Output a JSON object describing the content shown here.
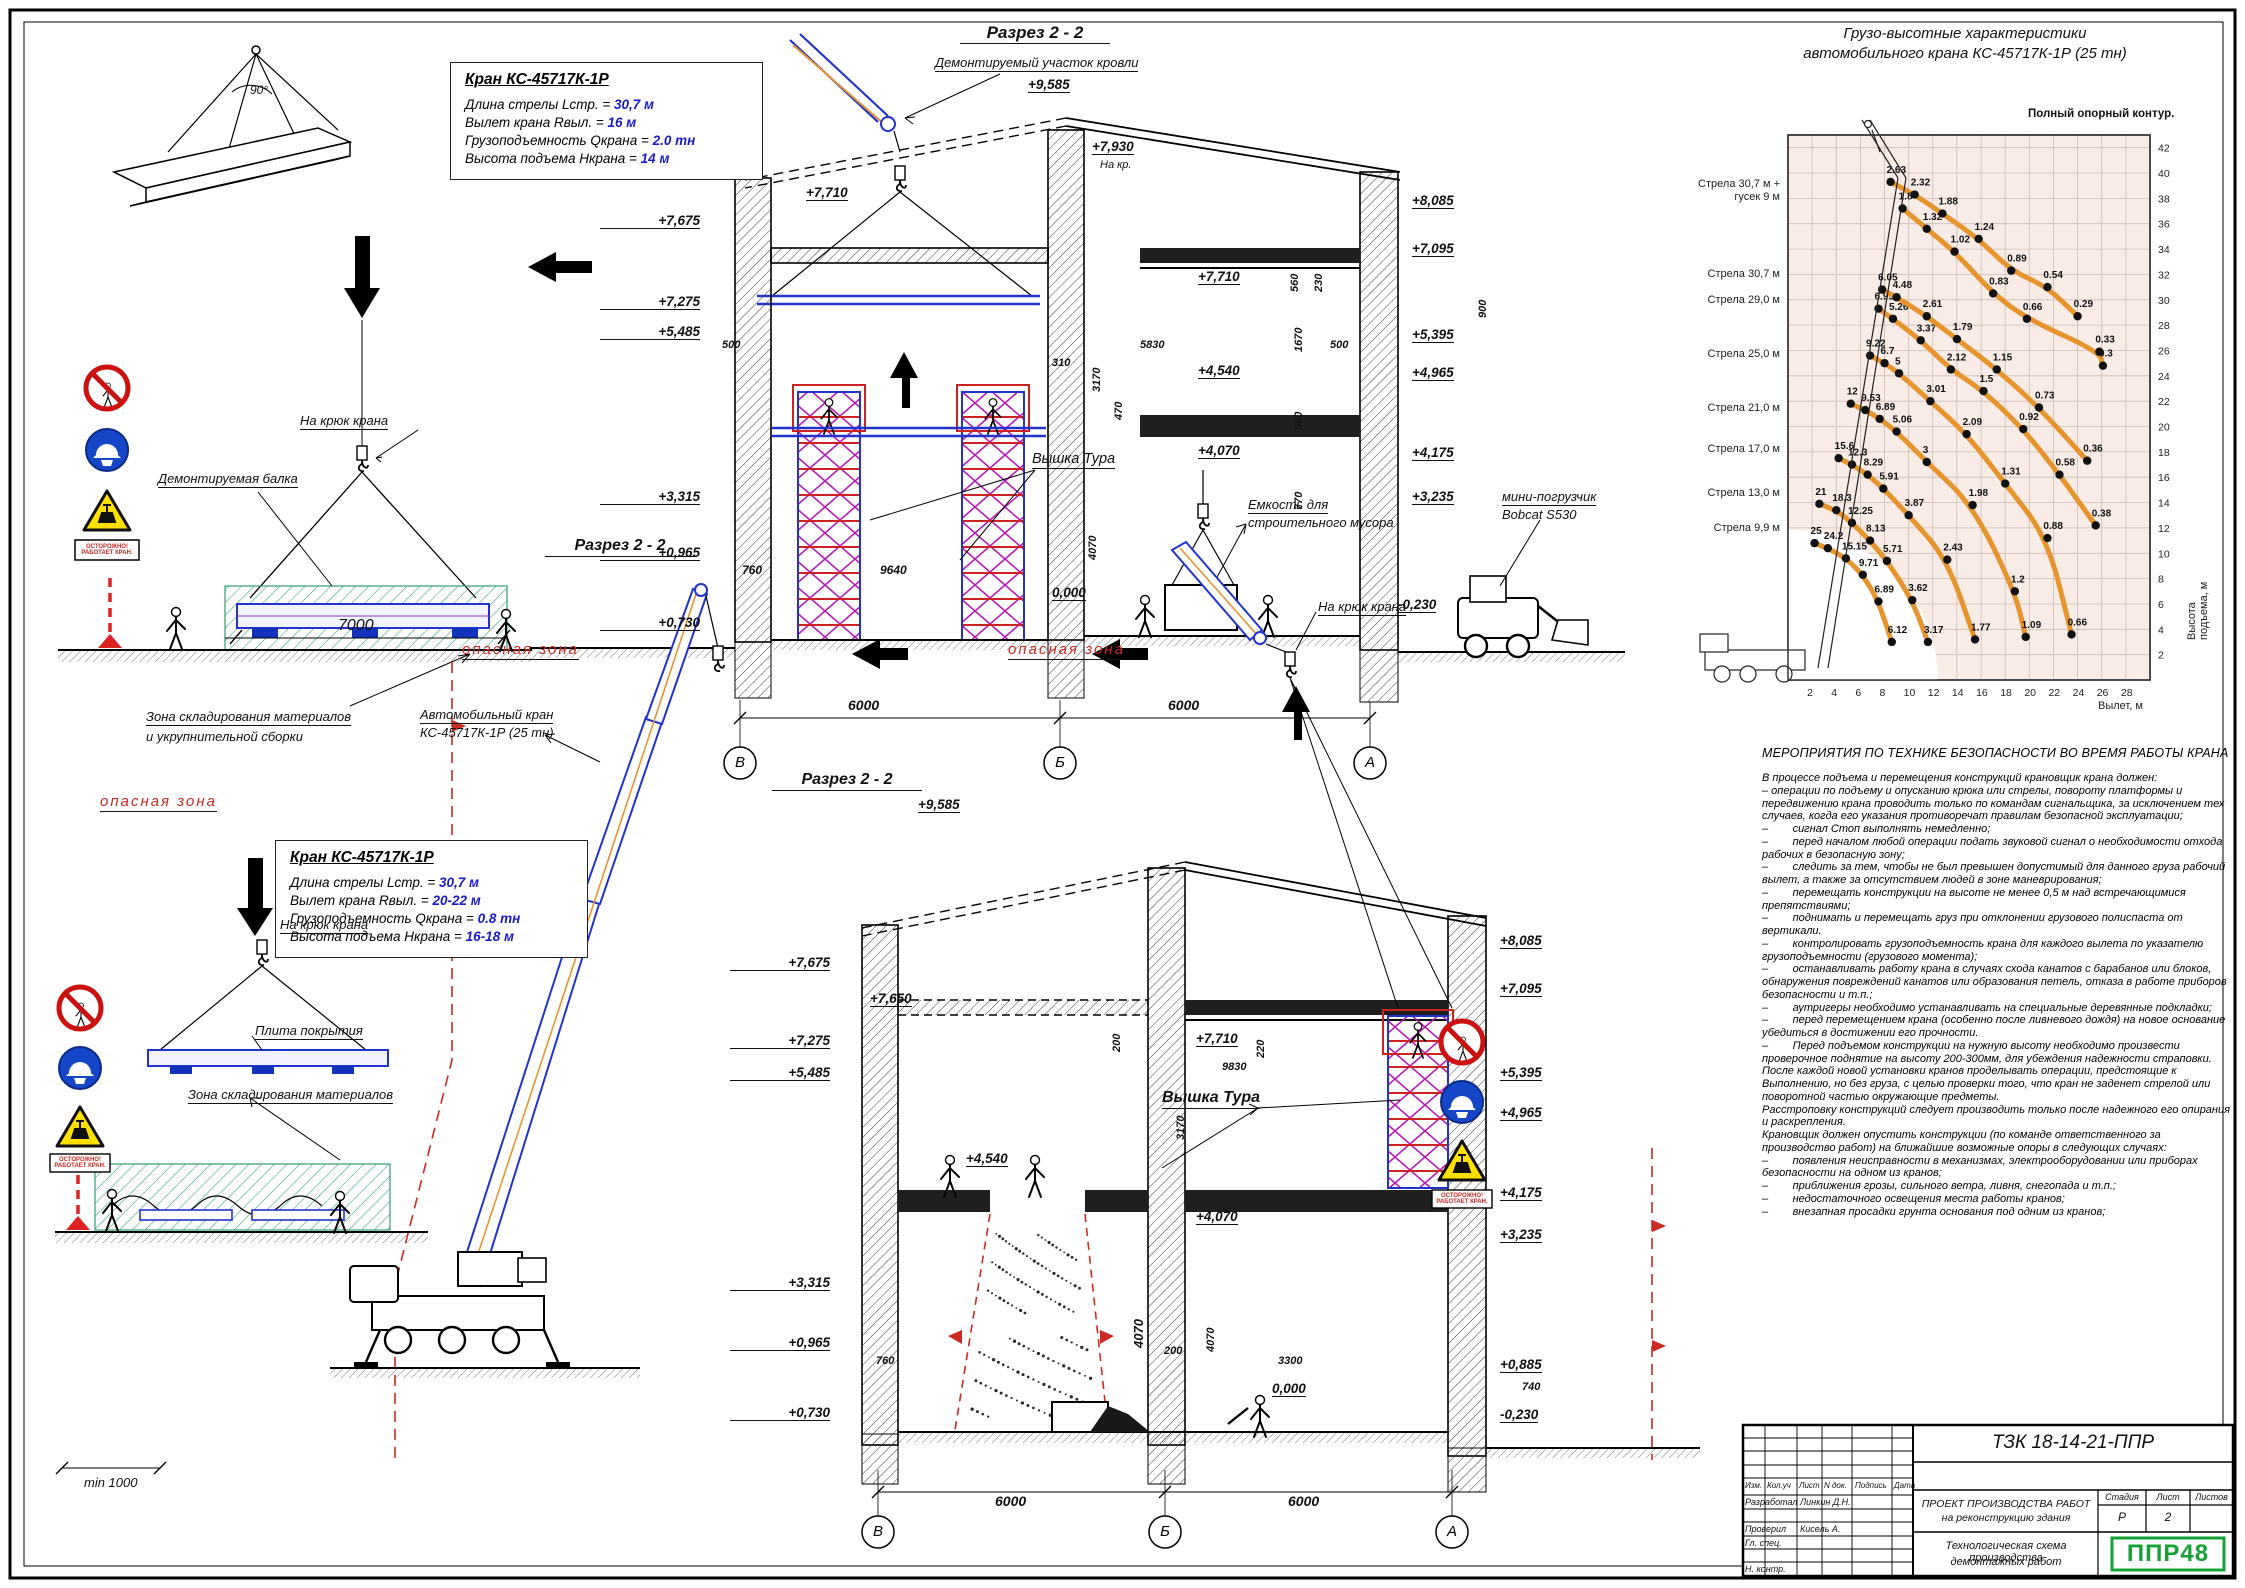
{
  "top_left": {
    "angle": "90°",
    "hook_label": "На крюк крана",
    "beam_label": "Демонтируемая балка",
    "zone_label_1": "Зона складирования материалов",
    "zone_label_2": "и укрупнительной сборки",
    "dim_7000": "7000",
    "warn_plate": "ОСТОРОЖНО! РАБОТАЕТ КРАН."
  },
  "crane_box_1": {
    "title": "Кран КС-45717К-1Р",
    "rows": [
      {
        "label": "Длина стрелы Lстр. = ",
        "value": "30,7 м"
      },
      {
        "label": "Вылет крана Rвыл. = ",
        "value": "16 м"
      },
      {
        "label": "Грузоподъемность Qкрана = ",
        "value": "2.0 тн"
      },
      {
        "label": "Высота подъема Нкрана = ",
        "value": "14 м"
      }
    ]
  },
  "crane_box_2": {
    "title": "Кран КС-45717К-1Р",
    "rows": [
      {
        "label": "Длина стрелы Lстр. = ",
        "value": "30,7 м"
      },
      {
        "label": "Вылет крана Rвыл. = ",
        "value": "20-22 м"
      },
      {
        "label": "Грузоподъемность Qкрана = ",
        "value": "0.8 тн"
      },
      {
        "label": "Высота подъема Нкрана = ",
        "value": "16-18 м"
      }
    ]
  },
  "scheme1": {
    "title": "Разрез 2 - 2",
    "roof_label": "Демонтируемый участок кровли",
    "na_kr": "На кр.",
    "tower_label": "Вышка Тура",
    "bin_label_1": "Емкость для",
    "bin_label_2": "строительного мусора",
    "bobcat_label_1": "мини-погрузчик",
    "bobcat_label_2": "Bobcat S530",
    "elev_left": [
      "+7,675",
      "+7,275",
      "+5,485",
      "+3,315",
      "+0,965",
      "+0,730"
    ],
    "elev_right": [
      "+8,085",
      "+7,095",
      "+5,395",
      "+4,965",
      "+4,175",
      "+3,235"
    ],
    "elev_inner": [
      "+9,585",
      "+7,930",
      "+7,710",
      "+7,710",
      "+4,540",
      "+4,070",
      "0,000",
      "-0,230"
    ],
    "dims": [
      "500",
      "5830",
      "500",
      "900",
      "560",
      "230",
      "1670",
      "940",
      "770",
      "310",
      "3170",
      "470",
      "9640",
      "760",
      "4070",
      "6000",
      "6000"
    ],
    "grid": [
      "В",
      "Б",
      "А"
    ]
  },
  "scheme2": {
    "title": "Разрез 2 - 2",
    "danger_label": "опасная зона",
    "crane_label_1": "Автомобильный кран",
    "crane_label_2": "КС-45717К-1Р (25 тн)",
    "hook_label": "На крюк крана",
    "tower_label": "Вышка Тура",
    "plate_label": "Плита покрытия",
    "zone_label": "Зона складирования материалов",
    "min_dim": "min 1000",
    "elev_left": [
      "+7,675",
      "+7,275",
      "+5,485",
      "+3,315",
      "+0,965",
      "+0,730"
    ],
    "elev_right": [
      "+8,085",
      "+7,095",
      "+5,395",
      "+4,965",
      "+4,175",
      "+3,235",
      "+0,885",
      "-0,230"
    ],
    "elev_inner": [
      "+9,585",
      "+7,650",
      "+7,710",
      "+4,540",
      "+4,070",
      "0,000"
    ],
    "dims": [
      "200",
      "220",
      "9830",
      "3170",
      "760",
      "4070",
      "4070",
      "200",
      "3300",
      "740",
      "6000",
      "6000"
    ],
    "grid": [
      "В",
      "Б",
      "А"
    ]
  },
  "chart_data": {
    "type": "line",
    "title_1": "Грузо-высотные характеристики",
    "title_2": "автомобильного крана КС-45717К-1Р (25 тн)",
    "note": "Полный опорный контур.",
    "xlabel": "Вылет, м",
    "ylabel": "Высота подъема, м",
    "xlim": [
      0,
      30
    ],
    "ylim": [
      0,
      43
    ],
    "xticks": [
      2,
      4,
      6,
      8,
      10,
      12,
      14,
      16,
      18,
      20,
      22,
      24,
      26,
      28
    ],
    "yticks": [
      2,
      4,
      6,
      8,
      10,
      12,
      14,
      16,
      18,
      20,
      22,
      24,
      26,
      28,
      30,
      32,
      34,
      36,
      38,
      40,
      42
    ],
    "legend": [
      "Стрела 30,7 м + гусек 9 м",
      "Стрела 30,7 м",
      "Стрела 29,0 м",
      "Стрела 25,0 м",
      "Стрела 21,0 м",
      "Стрела 17,0 м",
      "Стрела 13,0 м",
      "Стрела 9,9 м"
    ],
    "series": [
      {
        "name": "Стрела 9,9 м",
        "points": [
          {
            "x": 2.2,
            "y": 10.8,
            "q": "25"
          },
          {
            "x": 3.3,
            "y": 10.4,
            "q": "24.2"
          },
          {
            "x": 4.8,
            "y": 9.6,
            "q": "15.15"
          },
          {
            "x": 6.2,
            "y": 8.3,
            "q": "9.71"
          },
          {
            "x": 7.5,
            "y": 6.2,
            "q": "6.89"
          },
          {
            "x": 8.6,
            "y": 3.0,
            "q": "6.12"
          }
        ]
      },
      {
        "name": "Стрела 13,0 м",
        "points": [
          {
            "x": 2.6,
            "y": 13.9,
            "q": "21"
          },
          {
            "x": 4.0,
            "y": 13.4,
            "q": "18.3"
          },
          {
            "x": 5.3,
            "y": 12.4,
            "q": "12.25"
          },
          {
            "x": 6.8,
            "y": 11.0,
            "q": "8.13"
          },
          {
            "x": 8.2,
            "y": 9.4,
            "q": "5.71"
          },
          {
            "x": 10.3,
            "y": 6.3,
            "q": "3.62"
          },
          {
            "x": 11.6,
            "y": 3.0,
            "q": "3.17"
          }
        ]
      },
      {
        "name": "Стрела 17,0 м",
        "points": [
          {
            "x": 4.2,
            "y": 17.5,
            "q": "15.6"
          },
          {
            "x": 5.3,
            "y": 17.0,
            "q": "12.3"
          },
          {
            "x": 6.6,
            "y": 16.2,
            "q": "8.29"
          },
          {
            "x": 7.9,
            "y": 15.1,
            "q": "5.91"
          },
          {
            "x": 10.0,
            "y": 13.0,
            "q": "3.87"
          },
          {
            "x": 13.2,
            "y": 9.5,
            "q": "2.43"
          },
          {
            "x": 15.5,
            "y": 3.2,
            "q": "1.77"
          }
        ]
      },
      {
        "name": "Стрела 21,0 м",
        "points": [
          {
            "x": 5.2,
            "y": 21.8,
            "q": "12"
          },
          {
            "x": 6.4,
            "y": 21.3,
            "q": "9.53"
          },
          {
            "x": 7.6,
            "y": 20.6,
            "q": "6.89"
          },
          {
            "x": 9.0,
            "y": 19.6,
            "q": "5.06"
          },
          {
            "x": 11.5,
            "y": 17.2,
            "q": "3"
          },
          {
            "x": 15.3,
            "y": 13.8,
            "q": "1.98"
          },
          {
            "x": 18.8,
            "y": 7.0,
            "q": "1.2"
          },
          {
            "x": 19.7,
            "y": 3.4,
            "q": "1.09"
          }
        ]
      },
      {
        "name": "Стрела 25,0 м",
        "points": [
          {
            "x": 6.8,
            "y": 25.6,
            "q": "9.22"
          },
          {
            "x": 8.0,
            "y": 25.0,
            "q": "6.7"
          },
          {
            "x": 9.2,
            "y": 24.2,
            "q": "5"
          },
          {
            "x": 11.8,
            "y": 22.0,
            "q": "3.01"
          },
          {
            "x": 14.8,
            "y": 19.4,
            "q": "2.09"
          },
          {
            "x": 18.0,
            "y": 15.5,
            "q": "1.31"
          },
          {
            "x": 21.5,
            "y": 11.2,
            "q": "0.88"
          },
          {
            "x": 23.5,
            "y": 3.6,
            "q": "0.66"
          }
        ]
      },
      {
        "name": "Стрела 29,0 м",
        "points": [
          {
            "x": 7.5,
            "y": 29.3,
            "q": "6.95"
          },
          {
            "x": 8.7,
            "y": 28.5,
            "q": "5.26"
          },
          {
            "x": 11.0,
            "y": 26.8,
            "q": "3.37"
          },
          {
            "x": 13.5,
            "y": 24.5,
            "q": "2.12"
          },
          {
            "x": 16.2,
            "y": 22.8,
            "q": "1.5"
          },
          {
            "x": 19.5,
            "y": 19.8,
            "q": "0.92"
          },
          {
            "x": 22.5,
            "y": 16.2,
            "q": "0.58"
          },
          {
            "x": 25.5,
            "y": 12.2,
            "q": "0.38"
          }
        ]
      },
      {
        "name": "Стрела 30,7 м",
        "points": [
          {
            "x": 7.8,
            "y": 30.8,
            "q": "6.05"
          },
          {
            "x": 9.0,
            "y": 30.2,
            "q": "4.48"
          },
          {
            "x": 11.5,
            "y": 28.7,
            "q": "2.61"
          },
          {
            "x": 14.0,
            "y": 26.9,
            "q": "1.79"
          },
          {
            "x": 17.3,
            "y": 24.5,
            "q": "1.15"
          },
          {
            "x": 20.8,
            "y": 21.5,
            "q": "0.73"
          },
          {
            "x": 24.8,
            "y": 17.3,
            "q": "0.36"
          }
        ]
      },
      {
        "name": "Стрела 30,7 м + гусек 9 м",
        "points": [
          {
            "x": 8.5,
            "y": 39.3,
            "q": "2.63"
          },
          {
            "x": 10.5,
            "y": 38.3,
            "q": "2.32"
          },
          {
            "x": 12.8,
            "y": 36.8,
            "q": "1.88"
          },
          {
            "x": 15.8,
            "y": 34.8,
            "q": "1.24"
          },
          {
            "x": 18.5,
            "y": 32.3,
            "q": "0.89"
          },
          {
            "x": 21.5,
            "y": 31.0,
            "q": "0.54"
          },
          {
            "x": 24.0,
            "y": 28.7,
            "q": "0.29"
          }
        ]
      },
      {
        "name": "Стрела 30,7 м + гусек 9 м",
        "points": [
          {
            "x": 9.5,
            "y": 37.2,
            "q": "1.8"
          },
          {
            "x": 11.5,
            "y": 35.6,
            "q": "1.32"
          },
          {
            "x": 13.8,
            "y": 33.8,
            "q": "1.02"
          },
          {
            "x": 17.0,
            "y": 30.5,
            "q": "0.83"
          },
          {
            "x": 19.8,
            "y": 28.5,
            "q": "0.66"
          },
          {
            "x": 25.8,
            "y": 25.9,
            "q": "0.33"
          },
          {
            "x": 26.1,
            "y": 24.8,
            "q": "0.3"
          }
        ]
      }
    ]
  },
  "safety": {
    "heading": "МЕРОПРИЯТИЯ ПО ТЕХНИКЕ БЕЗОПАСНОСТИ ВО ВРЕМЯ РАБОТЫ КРАНА",
    "paragraphs": [
      "В процессе подъема и перемещения конструкций крановщик крана должен:",
      "– операции по подъему и опусканию крюка или стрелы, повороту платформы и передвижению крана проводить только по командам сигнальщика, за исключением тех случаев, когда его указания противоречат правилам безопасной эксплуатации;",
      "–        сигнал Стоп выполнять немедленно;",
      "–        перед началом любой операции подать звуковой сигнал о необходимости отхода рабочих в безопасную зону;",
      "–        следить за тем, чтобы не был превышен допустимый для данного груза рабочий вылет, а также за отсутствием людей в зоне маневрирования;",
      "–        перемещать конструкции на высоте не менее 0,5 м над встречающимися препятствиями;",
      "–        поднимать и перемещать груз при отклонении грузового полиспаста от вертикали.",
      "–        контролировать грузоподъемность крана для каждого вылета по указателю грузоподъемности (грузового момента);",
      "–        останавливать работу крана в случаях схода канатов с барабанов или блоков, обнаружения повреждений канатов или образования петель, отказа в работе приборов безопасности и т.п.;",
      "–        аутригеры необходимо устанавливать на специальные деревянные подкладки;",
      "–        перед перемещением крана (особенно после ливневого дождя) на новое основание убедиться в достижении его прочности.",
      "–        Перед подъемом конструкции на нужную высоту необходимо произвести проверочное поднятие на высоту 200-300мм, для убеждения надежности страповки.",
      "После каждой новой установки кранов проделывать операции, предстоящие к Выполнению, но без груза, с целью проверки того, что кран не заденет стрелой или поворотной частью окружающие предметы.",
      "Расстроповку конструкций следует производить только после надежного его опирания и раскрепления.",
      "Крановщик должен опустить конструкции (по команде ответственного за производство работ) на ближайшие возможные опоры в следующих случаях:",
      "–        появления неисправности в механизмах, электрооборудовании или приборах безопасности на одном из кранов;",
      "–        приближения грозы, сильного ветра, ливня, снегопада и т.п.;",
      "–        недостаточного освещения места работы кранов;",
      "–        внезапная просадки грунта основания под одним из кранов;"
    ]
  },
  "title_block": {
    "doc_code": "ТЗК 18-14-21-ППР",
    "cols": [
      "Изм.",
      "Кол.уч",
      "Лист",
      "N док.",
      "Подпись",
      "Дата"
    ],
    "row_dev_label": "Разработал",
    "row_dev_value": "Линкин Д.Н.",
    "row_chk_label": "Проверил",
    "row_chk_value": "Кисель А.",
    "row_spec_label": "Гл. спец.",
    "row_norm_label": "Н. контр.",
    "project_1": "ПРОЕКТ ПРОИЗВОДСТВА РАБОТ",
    "project_2": "на реконструкцию здания",
    "stage_label": "Стадия",
    "sheet_label": "Лист",
    "sheets_label": "Листов",
    "stage": "Р",
    "sheet": "2",
    "doc_title_1": "Технологическая схема производства",
    "doc_title_2": "демонтажных работ",
    "logo": "ППР48"
  },
  "colors": {
    "accent_blue": "#1a1acd",
    "danger_red": "#c92a21",
    "zone_green": "#2f9e70",
    "chart_orange": "#e6952e",
    "logo_green": "#18a038"
  }
}
